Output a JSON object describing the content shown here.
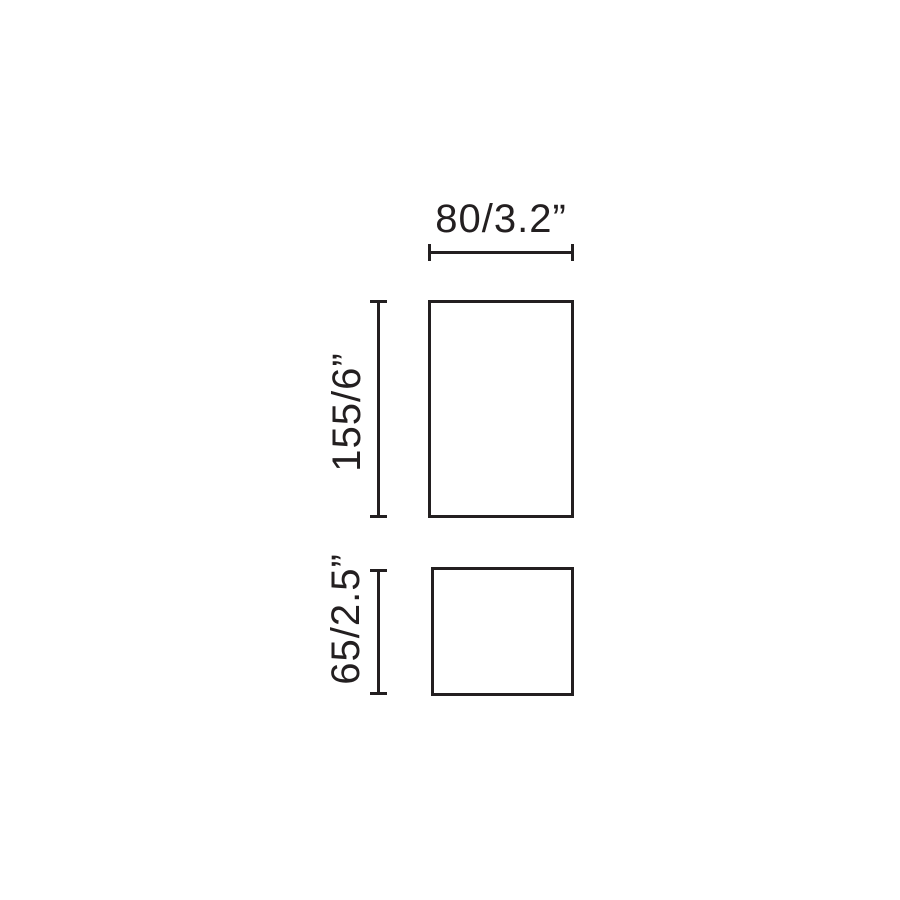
{
  "diagram": {
    "type": "technical-dimension-drawing",
    "ink_color": "#231f20",
    "background_color": "#ffffff",
    "labels": {
      "width": "80/3.2”",
      "height_body": "155/6”",
      "height_base": "65/2.5”"
    }
  }
}
